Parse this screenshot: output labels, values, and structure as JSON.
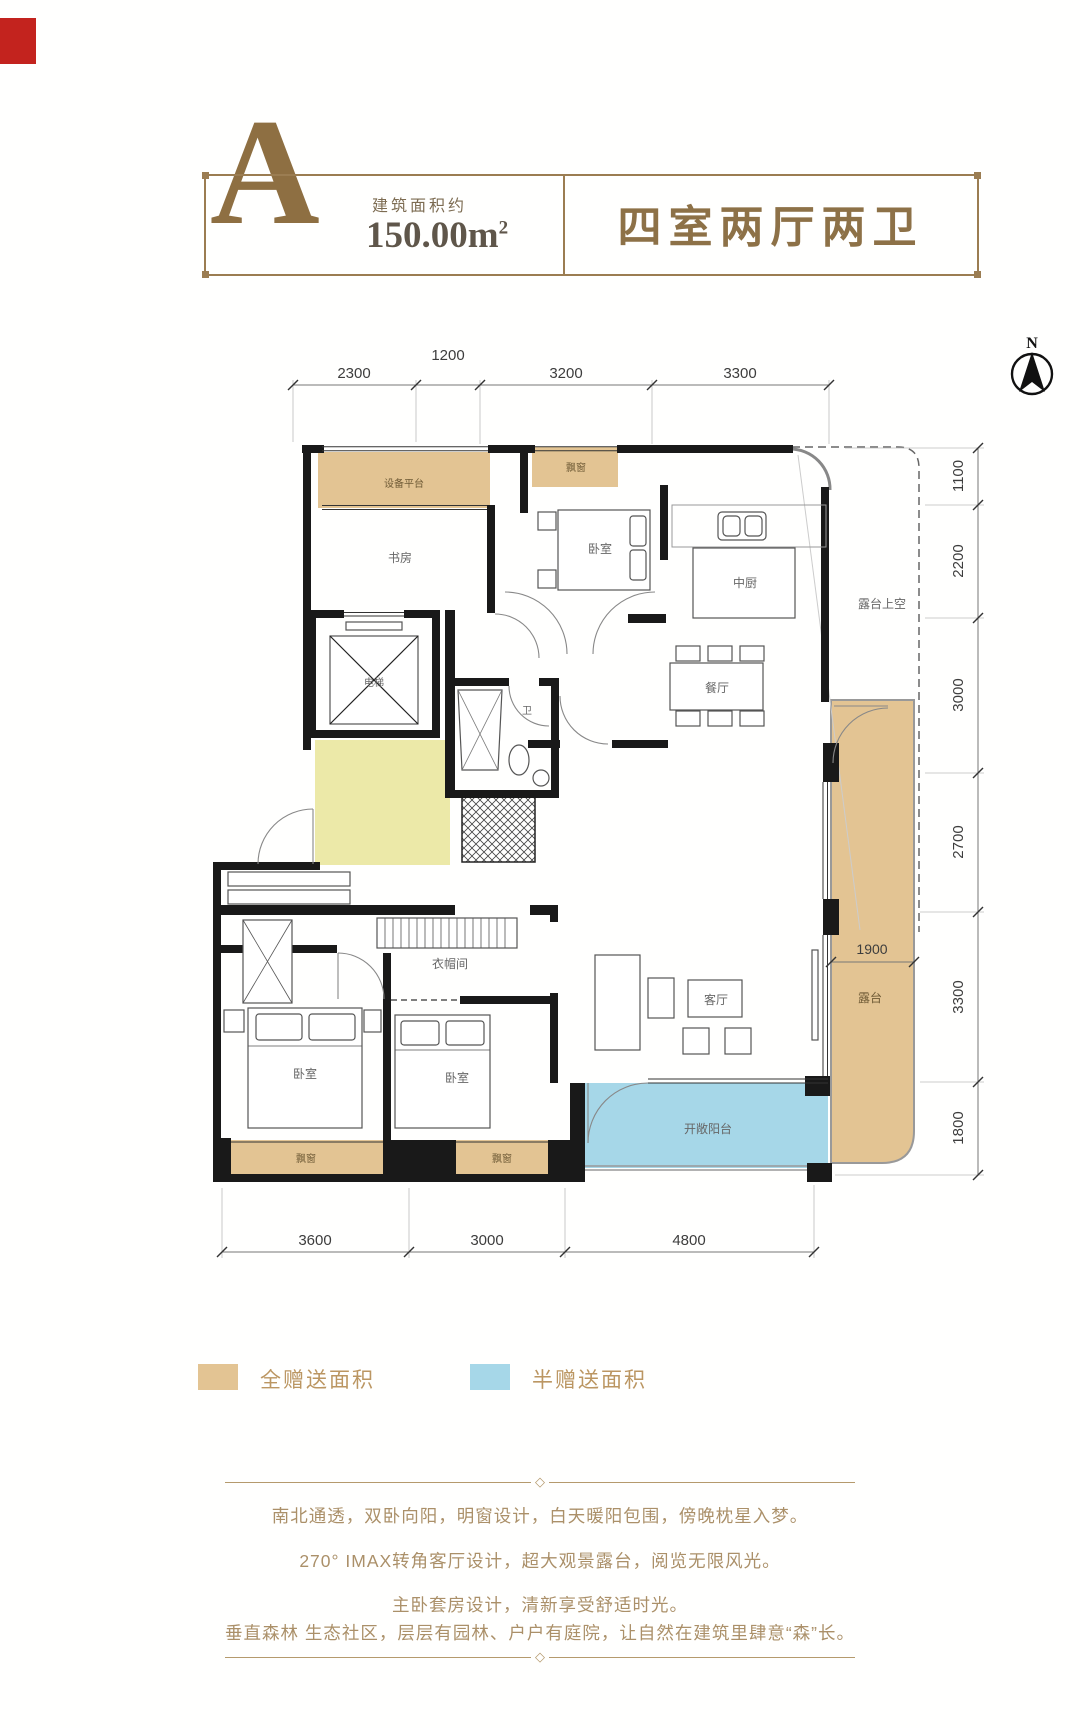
{
  "header": {
    "unit_letter": "A",
    "area_caption": "建筑面积约",
    "area_value": "150.00m",
    "area_exponent": "2",
    "unit_title": "四室两厅两卫",
    "accent_color": "#9b7d52"
  },
  "compass": {
    "north_label": "N"
  },
  "plan": {
    "dims_top": [
      "2300",
      "1200",
      "3200",
      "3300"
    ],
    "dims_right": [
      "1100",
      "2200",
      "3000",
      "2700",
      "3300",
      "1800"
    ],
    "dims_bottom": [
      "3600",
      "3000",
      "4800"
    ],
    "dim_inner": "1900",
    "rooms": {
      "equipment_platform": "设备平台",
      "study": "书房",
      "bay_window_top": "飘窗",
      "bedroom_top": "卧室",
      "kitchen": "中厨",
      "dining_room": "餐厅",
      "terrace_above": "露台上空",
      "elevator": "电梯",
      "bathroom": "卫",
      "cloakroom": "衣帽间",
      "bedroom_master": "卧室",
      "bedroom_second": "卧室",
      "living_room": "客厅",
      "terrace": "露台",
      "open_balcony": "开敞阳台",
      "bay_window_left": "飘窗",
      "bay_window_mid": "飘窗"
    },
    "zone_colors": {
      "full_gift_tan": "#e3c493",
      "half_gift_blue": "#a6d7e8",
      "entry_yellow": "#ece9a8",
      "wall_black": "#191919"
    }
  },
  "legend": {
    "items": [
      {
        "label": "全赠送面积",
        "color": "#e3c493"
      },
      {
        "label": "半赠送面积",
        "color": "#a6d7e8"
      }
    ]
  },
  "description": {
    "lines": [
      "南北通透，双卧向阳，明窗设计，白天暖阳包围，傍晚枕星入梦。",
      "270° IMAX转角客厅设计，超大观景露台，阅览无限风光。",
      "主卧套房设计，清新享受舒适时光。",
      "垂直森林 生态社区，层层有园林、户户有庭院，让自然在建筑里肆意“森”长。"
    ]
  }
}
